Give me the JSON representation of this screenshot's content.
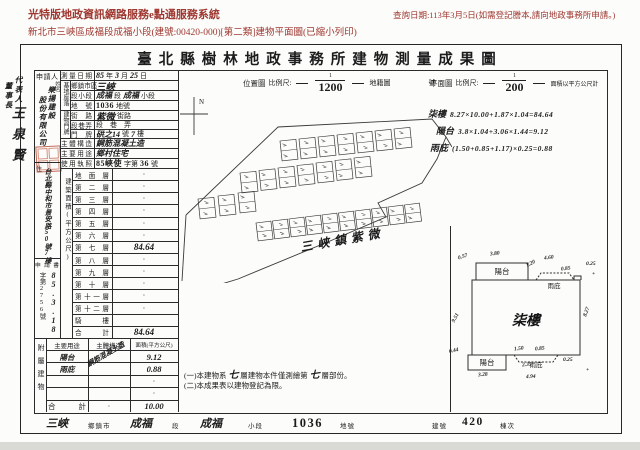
{
  "header": {
    "system_title": "光特版地政資訊網路服務e點通服務系統",
    "query_date": "查詢日期:113年3月5日(如需登記謄本,請向地政事務所申請。)",
    "subtitle": "新北市三峽區成福段成福小段(建號:00420-000)[第二類]建物平面圖(已縮小列印)"
  },
  "doc": {
    "title": "臺北縣樹林地政事務所建物測量成果圖",
    "representative": {
      "role": "代表人",
      "title": "董事長",
      "name": "王泉賢"
    },
    "applicant": {
      "label": "申請人",
      "name_label": "姓名",
      "name_col1": "樂揚建設",
      "name_col2": "股份有限公司",
      "address_label": "住",
      "address": "台北縣中和市景安路50號7樓",
      "receipt_label": "申請書",
      "receipt_no": "字第2756號",
      "receipt_date": "85.3.18"
    },
    "groups": {
      "site": "基地座落",
      "door": "建物門牌"
    },
    "info_rows": [
      {
        "label": "測量日期",
        "parts": [
          {
            "t": "85",
            "h": 1
          },
          {
            "t": "年"
          },
          {
            "t": "3",
            "h": 1
          },
          {
            "t": "月"
          },
          {
            "t": "25",
            "h": 1
          },
          {
            "t": "日"
          }
        ]
      },
      {
        "label": "鄉鎮市區",
        "group": "site",
        "parts": [
          {
            "t": "三峽",
            "h": 1,
            "big": 1
          }
        ]
      },
      {
        "label": "段 小段",
        "group": "site",
        "parts": [
          {
            "t": "成福",
            "h": 1
          },
          {
            "t": "段"
          },
          {
            "t": "成福",
            "h": 1
          },
          {
            "t": "小段"
          }
        ]
      },
      {
        "label": "地 號",
        "group": "site",
        "parts": [
          {
            "t": "1036",
            "b": 1
          },
          {
            "t": " 地號"
          }
        ]
      },
      {
        "label": "街 路",
        "group": "door",
        "parts": [
          {
            "t": "紫微",
            "h": 1,
            "big": 1
          },
          {
            "t": " 街路"
          }
        ]
      },
      {
        "label": "段巷弄",
        "group": "door",
        "parts": [
          {
            "t": "段　巷　弄"
          }
        ]
      },
      {
        "label": "門 牌",
        "group": "door",
        "parts": [
          {
            "t": "硔之14",
            "h": 1
          },
          {
            "t": "號"
          },
          {
            "t": "7",
            "h": 1
          },
          {
            "t": "樓"
          }
        ]
      },
      {
        "label": "主體構造",
        "parts": [
          {
            "t": "鋼筋混凝土造",
            "h": 1
          }
        ]
      },
      {
        "label": "主要用途",
        "parts": [
          {
            "t": "鄉村住宅",
            "h": 1
          }
        ]
      },
      {
        "label": "使用執照",
        "parts": [
          {
            "t": "85峽使",
            "b": 1
          },
          {
            "t": "字第"
          },
          {
            "t": "36",
            "b": 1
          },
          {
            "t": "號"
          }
        ]
      }
    ],
    "floor_section": {
      "label": "建築面積(平方公尺)",
      "floors": [
        {
          "name": "地面層",
          "value": "·"
        },
        {
          "name": "第二層",
          "value": "·"
        },
        {
          "name": "第三層",
          "value": "·"
        },
        {
          "name": "第四層",
          "value": "·"
        },
        {
          "name": "第五層",
          "value": "·"
        },
        {
          "name": "第六層",
          "value": "·"
        },
        {
          "name": "第七層",
          "value": "84.64",
          "hand": 1
        },
        {
          "name": "第八層",
          "value": "·"
        },
        {
          "name": "第九層",
          "value": "·"
        },
        {
          "name": "第十層",
          "value": "·"
        },
        {
          "name": "第十一層",
          "value": "·"
        },
        {
          "name": "第十二層",
          "value": "·"
        },
        {
          "name": "騎 樓",
          "value": ""
        },
        {
          "name": "合 計",
          "value": "84.64",
          "hand": 1
        }
      ]
    },
    "annex": {
      "label": "附屬建物",
      "headers": [
        "主要用途",
        "主體構造",
        "面積(平方公尺)"
      ],
      "structure": "鋼筋混凝土造",
      "rows": [
        {
          "use": "陽台",
          "useHand": 1,
          "mid": "",
          "area": "9.12",
          "hand": 1
        },
        {
          "use": "雨庇",
          "useHand": 1,
          "mid": "",
          "area": "0.88",
          "hand": 1
        },
        {
          "use": "",
          "mid": "",
          "area": "·"
        },
        {
          "use": "",
          "mid": "",
          "area": "·"
        },
        {
          "use": "合 計",
          "total": 1,
          "mid": "·",
          "area": "10.00",
          "hand": 1
        }
      ]
    },
    "map": {
      "scale_label": "位置圖",
      "scale_word": "比例尺:",
      "num": "1",
      "den": "1200",
      "cadastral": "地籍圖",
      "cadastral_suffix": "號",
      "north": "N",
      "place": "三峽鎮紫微",
      "building_rows": [
        {
          "x": 100,
          "y": 46,
          "n": 7,
          "dx": 19,
          "dy": -2,
          "w": 16,
          "h": 20,
          "rot": -6
        },
        {
          "x": 60,
          "y": 78,
          "n": 7,
          "dx": 19,
          "dy": -2.5,
          "w": 16,
          "h": 20,
          "rot": -6
        },
        {
          "x": 18,
          "y": 104,
          "n": 3,
          "dx": 20,
          "dy": -3,
          "w": 16,
          "h": 20,
          "rot": -6
        },
        {
          "x": 76,
          "y": 128,
          "n": 10,
          "dx": 16.5,
          "dy": -2,
          "w": 15,
          "h": 18,
          "rot": -7
        }
      ]
    },
    "plan": {
      "scale_label": "平面圖",
      "scale_word": "比例尺:",
      "num": "1",
      "den": "200",
      "unit_note": "面積以平方公尺計",
      "room": "柒樓",
      "balcony": "陽台",
      "canopy": "雨庇",
      "dims": [
        {
          "t": "0.57",
          "x": 18,
          "y": 19,
          "r": -18
        },
        {
          "t": "3.80",
          "x": 50,
          "y": 16,
          "r": -6
        },
        {
          "t": "1.20",
          "x": 86,
          "y": 26,
          "r": -28
        },
        {
          "t": "4.60",
          "x": 104,
          "y": 20,
          "r": -6
        },
        {
          "t": "0.85",
          "x": 121,
          "y": 31,
          "r": -8
        },
        {
          "t": "0.25",
          "x": 146,
          "y": 26,
          "r": 0
        },
        {
          "t": "8.27",
          "x": 142,
          "y": 74,
          "r": -70
        },
        {
          "t": "9.51",
          "x": 11,
          "y": 80,
          "r": -62
        },
        {
          "t": "0.44",
          "x": 9,
          "y": 113,
          "r": -12
        },
        {
          "t": "3.28",
          "x": 38,
          "y": 137,
          "r": -4
        },
        {
          "t": "1.50",
          "x": 74,
          "y": 111,
          "r": -6
        },
        {
          "t": "0.85",
          "x": 95,
          "y": 111,
          "r": -6
        },
        {
          "t": "2.35",
          "x": 82,
          "y": 127,
          "r": -4
        },
        {
          "t": "0.25",
          "x": 123,
          "y": 122,
          "r": 0
        },
        {
          "t": "4.94",
          "x": 86,
          "y": 139,
          "r": -2
        },
        {
          "t": "+",
          "x": 152,
          "y": 36,
          "r": 0
        },
        {
          "t": "+",
          "x": 146,
          "y": 132,
          "r": 0
        }
      ]
    },
    "calcs": [
      {
        "name": "柒樓",
        "formula": "8.27×10.00+1.87×1.04=84.64"
      },
      {
        "name": "陽台",
        "formula": "3.8×1.04+3.06×1.44=9.12"
      },
      {
        "name": "雨庇",
        "formula": "(1.50+0.85+1.17)×0.25=0.88"
      }
    ],
    "notes": [
      {
        "parts": [
          {
            "t": "(一)本建物系 "
          },
          {
            "t": "七",
            "h": 1
          },
          {
            "t": " 層建物本件僅測繪第 "
          },
          {
            "t": "七",
            "h": 1
          },
          {
            "t": " 層部份。"
          }
        ]
      },
      {
        "parts": [
          {
            "t": "(二)本成果表以建物登記為限。"
          }
        ]
      }
    ],
    "footer": [
      {
        "t": "三峽",
        "k": "hand"
      },
      {
        "t": "鄉鎮市",
        "k": "label"
      },
      {
        "t": "成福",
        "k": "hand"
      },
      {
        "t": "段",
        "k": "label"
      },
      {
        "t": "成福",
        "k": "hand"
      },
      {
        "t": "小段",
        "k": "label"
      },
      {
        "t": "1036",
        "k": "typed"
      },
      {
        "t": "地號",
        "k": "label"
      },
      {
        "t": "建號",
        "k": "label"
      },
      {
        "t": "420",
        "k": "typed"
      },
      {
        "t": "棟次",
        "k": "label"
      }
    ]
  },
  "colors": {
    "header_red": "#9e3730",
    "seal_red": "#b9523e",
    "ink": "#1c1c1c"
  }
}
